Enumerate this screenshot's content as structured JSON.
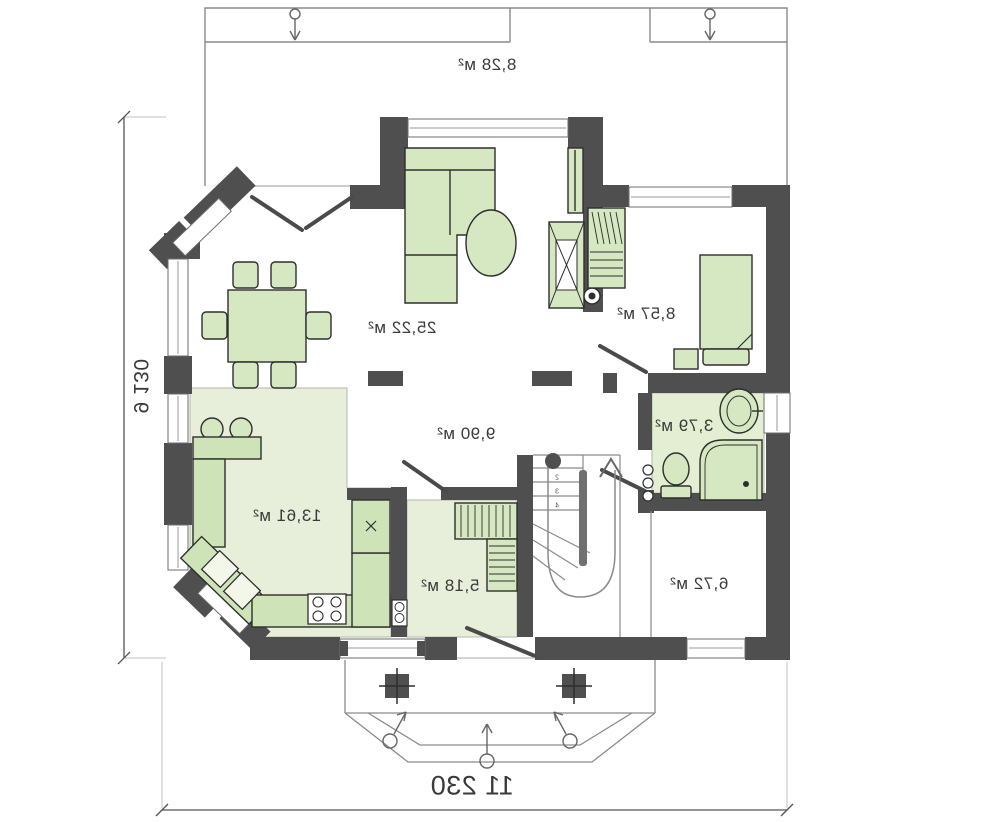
{
  "plan": {
    "rooms": {
      "terrace": {
        "area": "8,28 м²"
      },
      "living": {
        "area": "25,22 м²"
      },
      "bedroom": {
        "area": "8,57 м²"
      },
      "bathroom": {
        "area": "3,79 м²"
      },
      "hall": {
        "area": "9,90 м²"
      },
      "kitchen": {
        "area": "13,61 м²"
      },
      "wardrobe": {
        "area": "5,18 м²"
      },
      "entry": {
        "area": "6,72 м²"
      }
    },
    "dimensions": {
      "width": "11 230",
      "height": "9 130"
    },
    "stairs": {
      "steps": [
        "1",
        "2",
        "3",
        "4"
      ]
    },
    "colors": {
      "wall": "#4f4f4f",
      "furniture": "#d6e8c2",
      "floor": "#e7efdb",
      "counter": "#cfe3b8",
      "outline": "#2e2e2e",
      "thin_line": "#8a8a8a",
      "text": "#3a3a3a",
      "background": "#ffffff"
    }
  }
}
